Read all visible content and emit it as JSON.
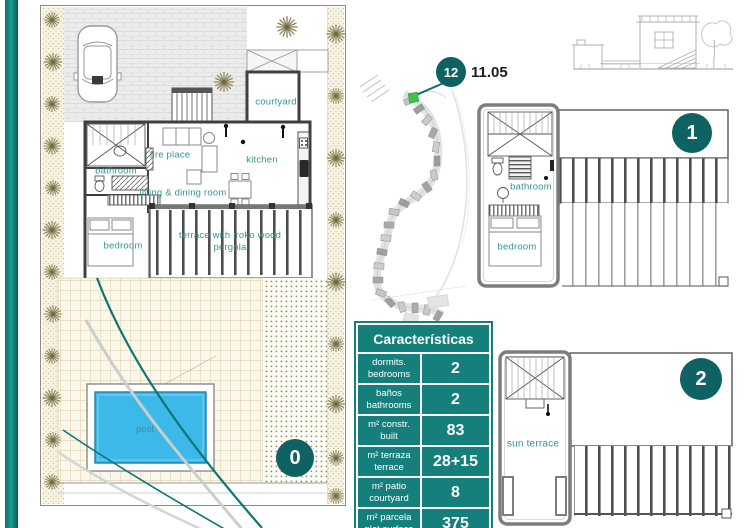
{
  "colors": {
    "accent_teal": "#15807b",
    "badge_teal": "#0e6263",
    "pool_blue": "#3cb9e8",
    "marker_green": "#3fc24e",
    "room_label_teal": "#35948e"
  },
  "site": {
    "plot_badge": "12",
    "elevation_value": "11.05"
  },
  "floor0": {
    "badge": "0",
    "labels": {
      "courtyard": "courtyard",
      "fireplace": "fire place",
      "kitchen": "kitchen",
      "bathroom": "bathroom",
      "living_dining": "living & dining room",
      "bedroom": "bedroom",
      "terrace": "terrace with iroko wood pergola",
      "pool": "pool"
    }
  },
  "floor1": {
    "badge": "1",
    "labels": {
      "bathroom": "bathroom",
      "bedroom": "bedroom"
    }
  },
  "floor2": {
    "badge": "2",
    "labels": {
      "sun_terrace": "sun terrace"
    }
  },
  "table": {
    "title": "Características",
    "rows": [
      {
        "label_primary": "dormits.",
        "label_secondary": "bedrooms",
        "value": "2"
      },
      {
        "label_primary": "baños",
        "label_secondary": "bathrooms",
        "value": "2"
      },
      {
        "label_primary": "m² constr.",
        "label_secondary": "built",
        "value": "83"
      },
      {
        "label_primary": "m² terraza",
        "label_secondary": "terrace",
        "value": "28+15"
      },
      {
        "label_primary": "m² patio",
        "label_secondary": "courtyard",
        "value": "8"
      },
      {
        "label_primary": "m² parcela",
        "label_secondary": "plot surface",
        "value": "375"
      }
    ]
  }
}
